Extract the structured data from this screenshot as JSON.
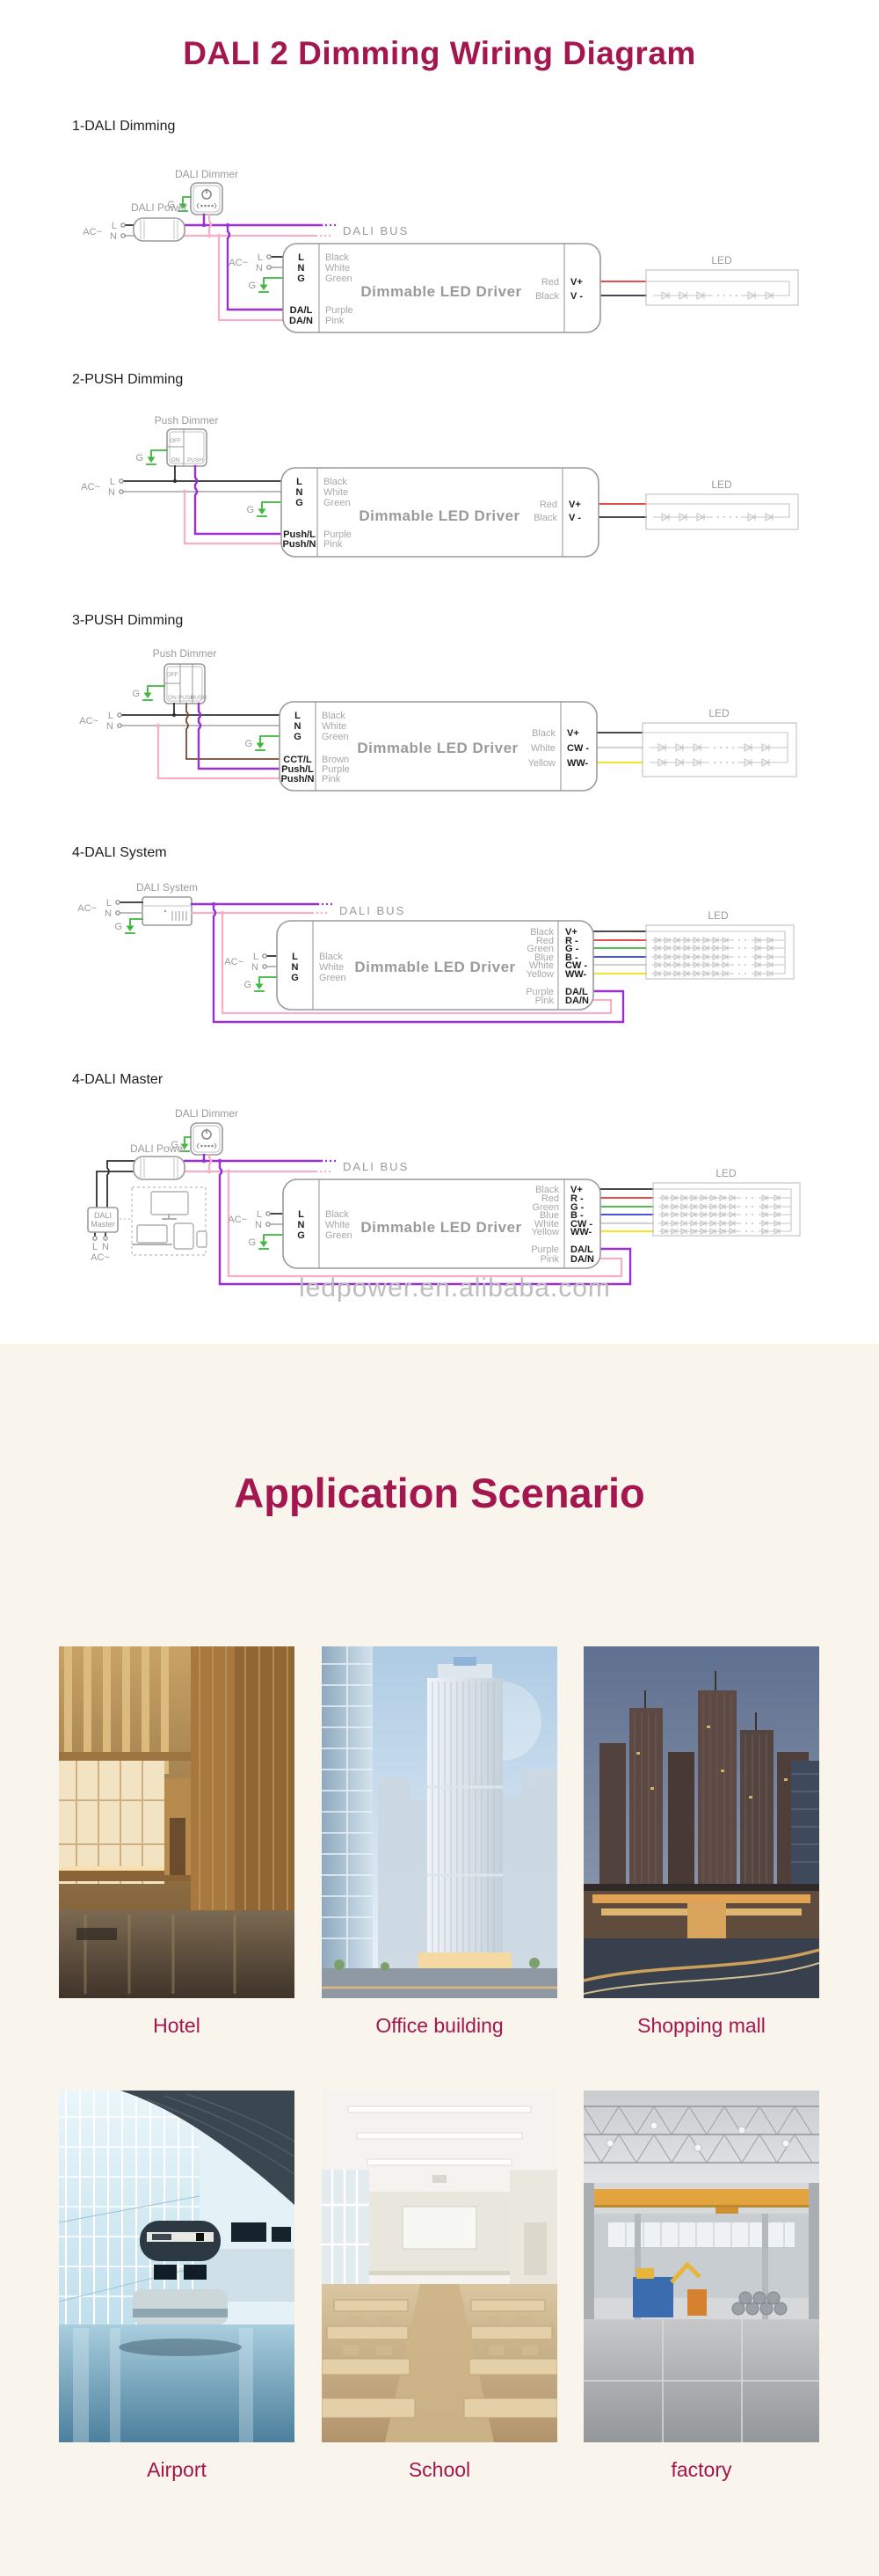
{
  "title": "DALI 2 Dimming Wiring Diagram",
  "watermark": "ledpower.en.alibaba.com",
  "colors": {
    "accent": "#A3164E",
    "section_background": "#FAF5EC",
    "wire_purple": "#9B2FD6",
    "wire_pink": "#F6AEC9",
    "wire_green": "#3CB83C",
    "wire_red": "#E03434",
    "wire_yellow": "#F3E13C",
    "wire_blue": "#2C3ED4",
    "wire_brown": "#7A4A32",
    "wire_black": "#2F2F2F"
  },
  "d1": {
    "section": "1-DALI Dimming",
    "dimmer_label": "DALI Dimmer",
    "power_label": "DALI Power",
    "bus_label": "DALI  BUS",
    "ac": "AC~",
    "l": "L",
    "n": "N",
    "g": "G",
    "driver_label": "Dimmable LED Driver",
    "led_label": "LED",
    "in_pins": [
      "L",
      "N",
      "G"
    ],
    "in_wires": [
      "Black",
      "White",
      "Green"
    ],
    "sig_pins": [
      "DA/L",
      "DA/N"
    ],
    "sig_wires": [
      "Purple",
      "Pink"
    ],
    "out_wires": [
      "Red",
      "Black"
    ],
    "out_pins": [
      "V+",
      "V -"
    ]
  },
  "d2": {
    "section": "2-PUSH Dimming",
    "dimmer_label": "Push Dimmer",
    "switch": [
      "OFF",
      "ON",
      "PUSH"
    ],
    "ac": "AC~",
    "l": "L",
    "n": "N",
    "g": "G",
    "driver_label": "Dimmable LED Driver",
    "led_label": "LED",
    "in_pins": [
      "L",
      "N",
      "G"
    ],
    "in_wires": [
      "Black",
      "White",
      "Green"
    ],
    "sig_pins": [
      "Push/L",
      "Push/N"
    ],
    "sig_wires": [
      "Purple",
      "Pink"
    ],
    "out_wires": [
      "Red",
      "Black"
    ],
    "out_pins": [
      "V+",
      "V -"
    ]
  },
  "d3": {
    "section": "3-PUSH Dimming",
    "dimmer_label": "Push Dimmer",
    "switch": [
      "OFF",
      "ON",
      "PUSH",
      "PUSH"
    ],
    "ac": "AC~",
    "l": "L",
    "n": "N",
    "g": "G",
    "driver_label": "Dimmable LED Driver",
    "led_label": "LED",
    "in_pins": [
      "L",
      "N",
      "G"
    ],
    "in_wires": [
      "Black",
      "White",
      "Green"
    ],
    "sig_pins": [
      "CCT/L",
      "Push/L",
      "Push/N"
    ],
    "sig_wires": [
      "Brown",
      "Purple",
      "Pink"
    ],
    "out_wires": [
      "Black",
      "White",
      "Yellow"
    ],
    "out_pins": [
      "V+",
      "CW -",
      "WW-"
    ]
  },
  "d4": {
    "section": "4-DALI System",
    "device_label": "DALI System",
    "bus_label": "DALI  BUS",
    "ac": "AC~",
    "l": "L",
    "n": "N",
    "g": "G",
    "driver_label": "Dimmable LED Driver",
    "led_label": "LED",
    "in_pins": [
      "L",
      "N",
      "G"
    ],
    "in_wires": [
      "Black",
      "White",
      "Green"
    ],
    "out_wires": [
      "Black",
      "Red",
      "Green",
      "Blue",
      "White",
      "Yellow"
    ],
    "out_pins": [
      "V+",
      "R -",
      "G -",
      "B -",
      "CW -",
      "WW-"
    ],
    "sig_pins": [
      "DA/L",
      "DA/N"
    ],
    "sig_wires": [
      "Purple",
      "Pink"
    ]
  },
  "d5": {
    "section": "4-DALI Master",
    "dimmer_label": "DALI Dimmer",
    "power_label": "DALI Power",
    "master_line1": "DALI",
    "master_line2": "Master",
    "bus_label": "DALI  BUS",
    "ac": "AC~",
    "l": "L",
    "n": "N",
    "g": "G",
    "driver_label": "Dimmable LED Driver",
    "led_label": "LED",
    "in_pins": [
      "L",
      "N",
      "G"
    ],
    "in_wires": [
      "Black",
      "White",
      "Green"
    ],
    "out_wires": [
      "Black",
      "Red",
      "Green",
      "Blue",
      "White",
      "Yellow"
    ],
    "out_pins": [
      "V+",
      "R -",
      "G -",
      "B -",
      "CW -",
      "WW-"
    ],
    "sig_pins": [
      "DA/L",
      "DA/N"
    ],
    "sig_wires": [
      "Purple",
      "Pink"
    ]
  },
  "app": {
    "title": "Application Scenario",
    "items": [
      {
        "caption": "Hotel"
      },
      {
        "caption": "Office building"
      },
      {
        "caption": "Shopping mall"
      },
      {
        "caption": "Airport"
      },
      {
        "caption": "School"
      },
      {
        "caption": "factory"
      }
    ]
  }
}
